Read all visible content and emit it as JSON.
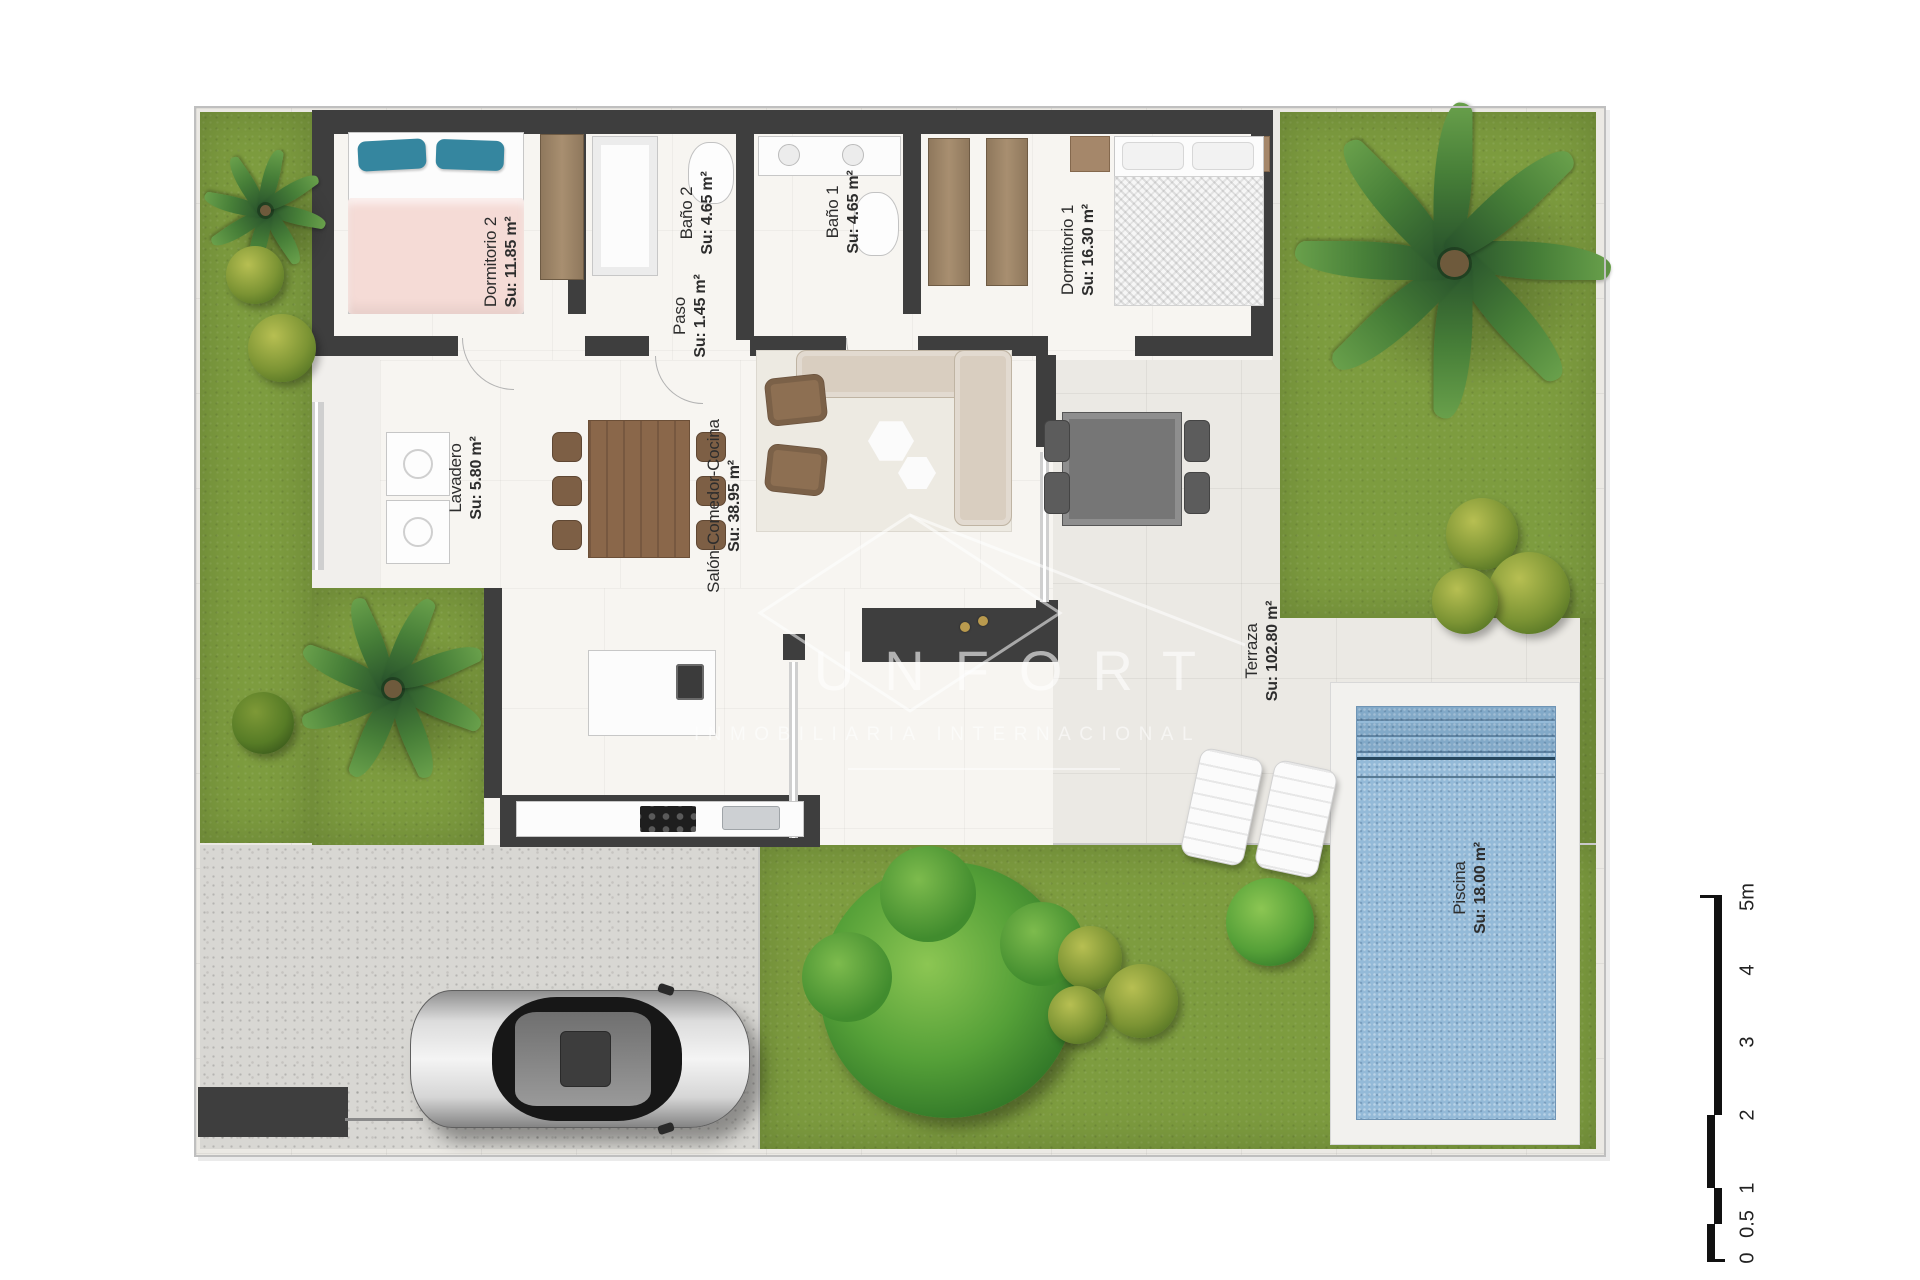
{
  "rooms": [
    {
      "name": "Dormitorio 2",
      "area": "Su: 11.85 m²"
    },
    {
      "name": "Baño 2",
      "area": "Su: 4.65 m²"
    },
    {
      "name": "Paso",
      "area": "Su: 1.45 m²"
    },
    {
      "name": "Baño 1",
      "area": "Su: 4.65 m²"
    },
    {
      "name": "Dormitorio 1",
      "area": "Su: 16.30 m²"
    },
    {
      "name": "Lavadero",
      "area": "Su: 5.80 m²"
    },
    {
      "name": "Salón-Comedor-Cocina",
      "area": "Su: 38.95 m²"
    },
    {
      "name": "Terraza",
      "area": "Su: 102.80 m²"
    },
    {
      "name": "Piscina",
      "area": "Su: 18.00 m²"
    }
  ],
  "watermark": {
    "brand": "UNFORT",
    "tagline": "INMOBILIARIA INTERNACIONAL"
  },
  "scale_bar": {
    "unit_labels": [
      "0",
      "0.5",
      "1",
      "2",
      "3",
      "4",
      "5m"
    ]
  },
  "colors": {
    "wall": "#3e3e3e",
    "grass": "#7d9c3f",
    "pool-water": "#94bad8",
    "duvet-pink": "#f5dbd6",
    "pillow-blue": "#35869f",
    "wood": "#8a674a"
  }
}
